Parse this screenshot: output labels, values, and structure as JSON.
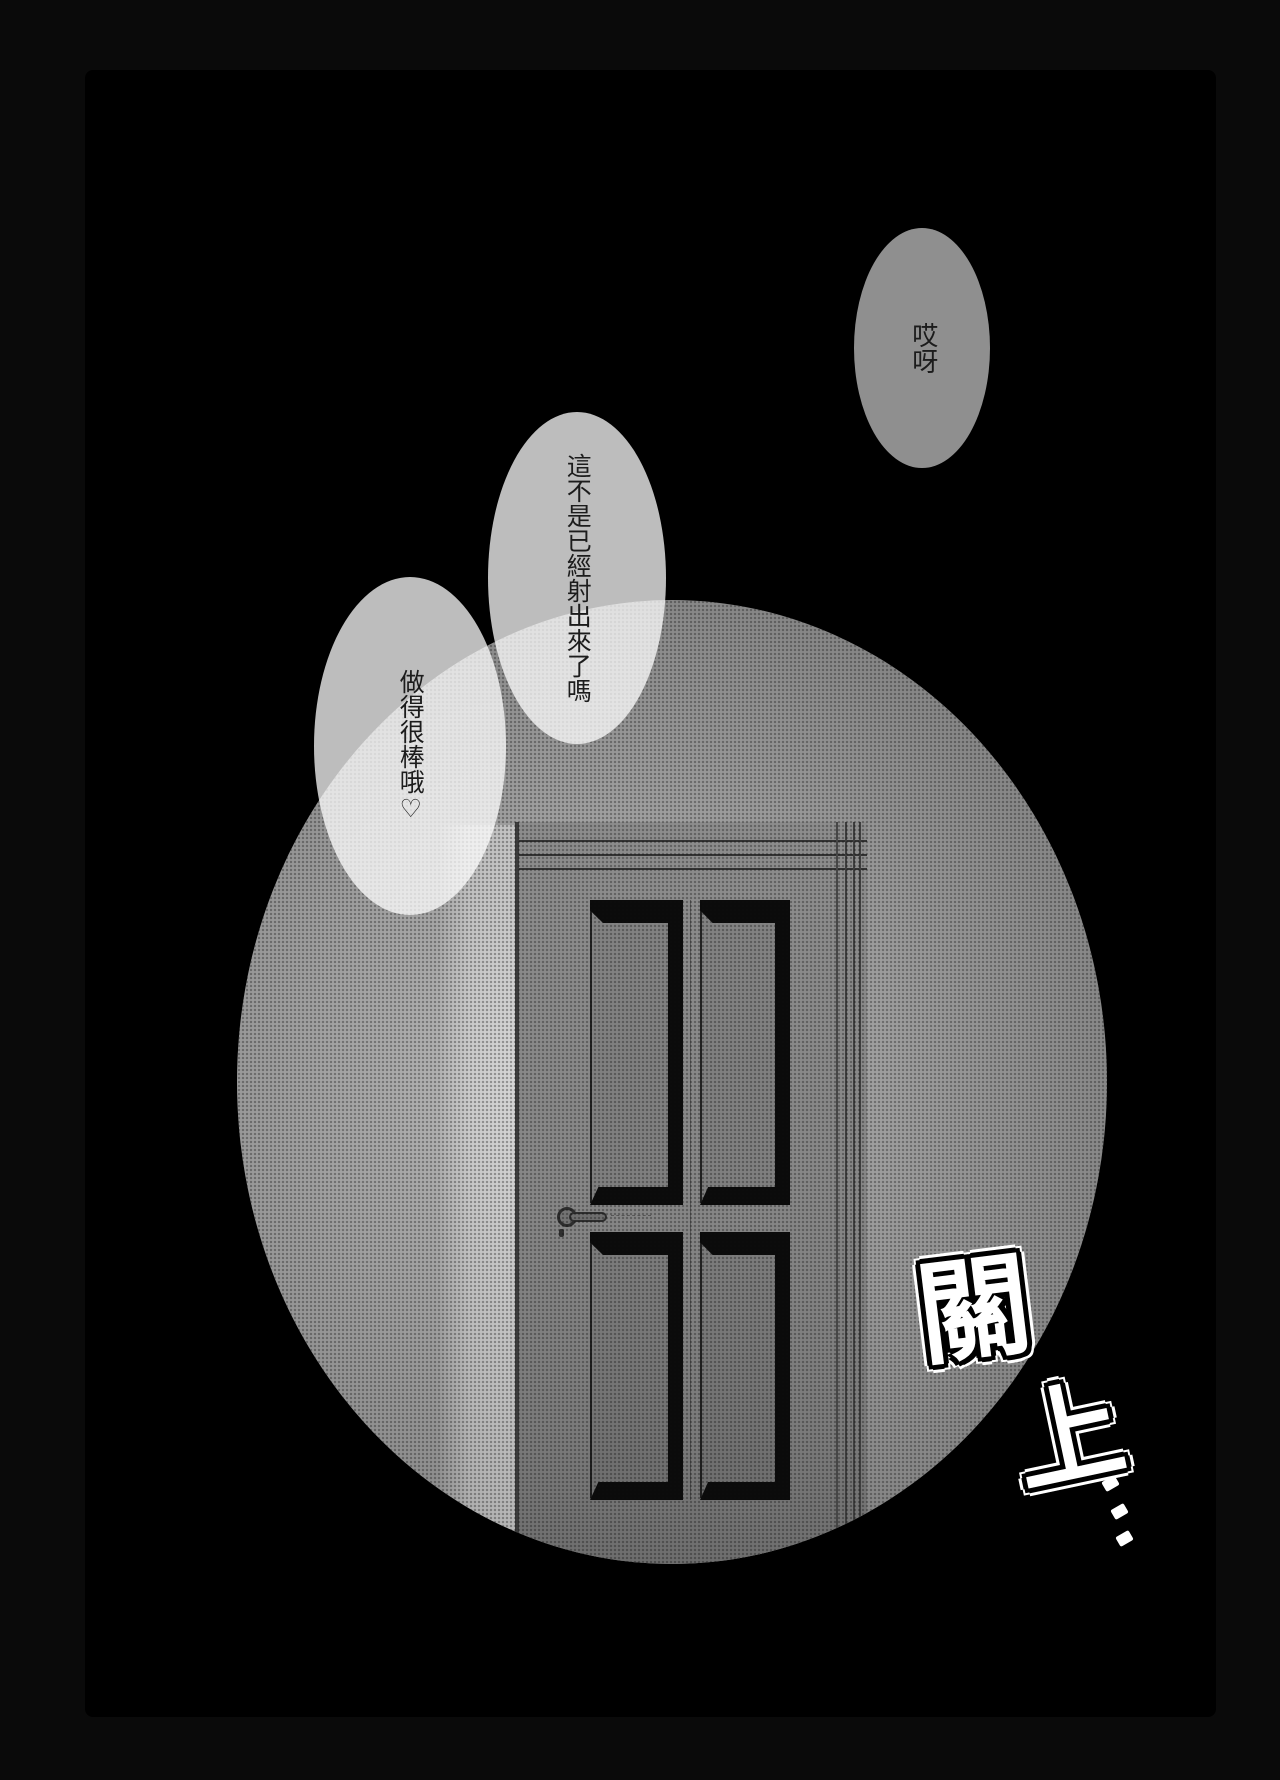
{
  "page": {
    "outer_bg": "#0a0a0a",
    "panel_bg": "#000000",
    "style": "manga page, single dark panel with halftone spotlight vignette"
  },
  "speech_bubbles": [
    {
      "text": "哎呀",
      "fill": "rgba(255,255,255,0.56)"
    },
    {
      "text": "這不是已經射出來了嗎",
      "fill": "rgba(255,255,255,0.74)"
    },
    {
      "text": "做得很棒哦♡",
      "fill": "rgba(255,255,255,0.74)"
    }
  ],
  "sfx": {
    "char_1": "關",
    "char_2": "上",
    "ellipsis_dot_count": 3,
    "color": "#ffffff",
    "outline_color": "#000000"
  },
  "scene": {
    "vignette_shape": "halftone-circle",
    "tone_base_color": "#9a9a9a",
    "door": {
      "panel_rows": 2,
      "panel_cols": 2,
      "panel_color": "#0b0b0b",
      "face_color": "#868686",
      "handle_side": "left",
      "molding_line_count": 3
    }
  }
}
